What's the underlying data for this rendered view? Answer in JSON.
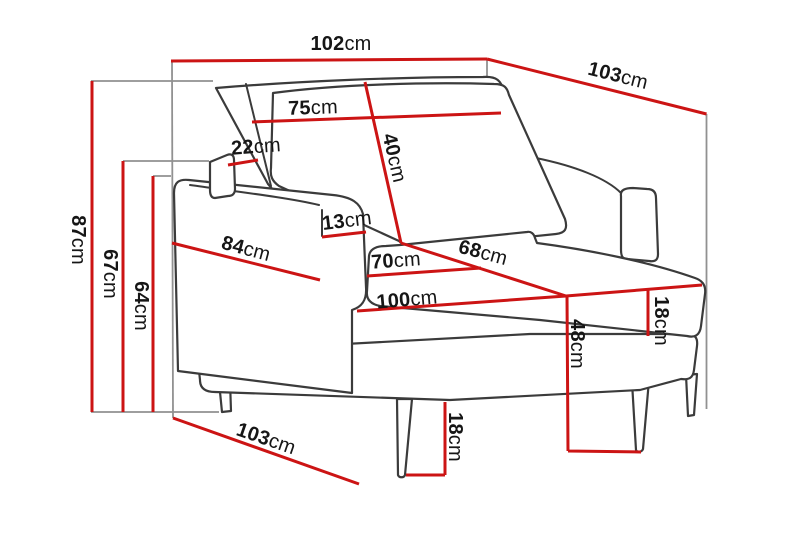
{
  "diagram_type": "armchair-dimension-drawing",
  "colors": {
    "dimension_line": "#cc1414",
    "extension_line": "#919191",
    "outline": "#3b3b3b",
    "background": "#ffffff",
    "text": "#161616"
  },
  "measurements": {
    "overall_width": {
      "value": "102",
      "unit": "cm"
    },
    "overall_depth": {
      "value": "103",
      "unit": "cm"
    },
    "overall_height": {
      "value": "87",
      "unit": "cm"
    },
    "back_frame_height": {
      "value": "67",
      "unit": "cm"
    },
    "armrest_height": {
      "value": "64",
      "unit": "cm"
    },
    "backrest_width": {
      "value": "75",
      "unit": "cm"
    },
    "backrest_depth": {
      "value": "22",
      "unit": "cm"
    },
    "back_cushion_height": {
      "value": "40",
      "unit": "cm"
    },
    "armrest_width": {
      "value": "13",
      "unit": "cm"
    },
    "side_depth": {
      "value": "84",
      "unit": "cm"
    },
    "seat_width": {
      "value": "70",
      "unit": "cm"
    },
    "seat_depth": {
      "value": "68",
      "unit": "cm"
    },
    "seat_front_width": {
      "value": "100",
      "unit": "cm"
    },
    "seat_height": {
      "value": "48",
      "unit": "cm"
    },
    "seat_cushion_thickness": {
      "value": "18",
      "unit": "cm"
    },
    "leg_height": {
      "value": "18",
      "unit": "cm"
    },
    "base_depth": {
      "value": "103",
      "unit": "cm"
    }
  }
}
